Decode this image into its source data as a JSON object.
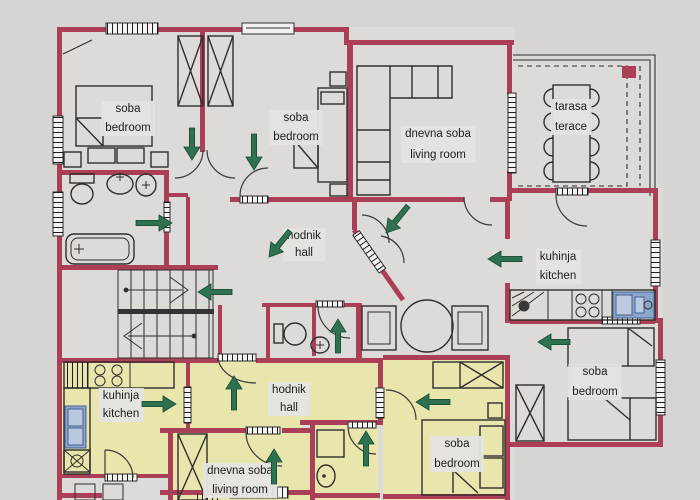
{
  "plan": {
    "type": "apartment floor plan",
    "colors": {
      "bg": "#d6d5d2",
      "room": "#dcdbd7",
      "room_highlight": "#e8e6ad",
      "wall": "#ac3f58",
      "ink": "#2f2e2c",
      "arrow_green": "#2f7252",
      "arrow_green_dark": "#174a30",
      "blue": "#8ba6cc",
      "label_bg": "#e5e4e0",
      "text": "#1c1c1b"
    },
    "labels": [
      {
        "id": "bedroom-top-left",
        "x": 128,
        "lines": [
          {
            "t": "soba",
            "y": 112
          },
          {
            "t": "bedroom",
            "y": 131
          }
        ]
      },
      {
        "id": "bedroom-top-center",
        "x": 296,
        "lines": [
          {
            "t": "soba",
            "y": 121
          },
          {
            "t": "bedroom",
            "y": 140
          }
        ]
      },
      {
        "id": "living-room-top",
        "x": 438,
        "lines": [
          {
            "t": "dnevna soba",
            "y": 137
          },
          {
            "t": "living room",
            "y": 158
          }
        ]
      },
      {
        "id": "terrace",
        "x": 571,
        "lines": [
          {
            "t": "tarasa",
            "y": 110
          },
          {
            "t": "terace",
            "y": 130
          }
        ]
      },
      {
        "id": "hall-upper",
        "x": 304,
        "lines": [
          {
            "t": "hodnik",
            "y": 239
          },
          {
            "t": "hall",
            "y": 256
          }
        ]
      },
      {
        "id": "kitchen-right",
        "x": 558,
        "lines": [
          {
            "t": "kuhinja",
            "y": 260
          },
          {
            "t": "kitchen",
            "y": 279
          }
        ]
      },
      {
        "id": "bedroom-right",
        "x": 595,
        "lines": [
          {
            "t": "soba",
            "y": 375
          },
          {
            "t": "bedroom",
            "y": 395
          }
        ]
      },
      {
        "id": "kitchen-lower",
        "x": 121,
        "lines": [
          {
            "t": "kuhinja",
            "y": 399
          },
          {
            "t": "kitchen",
            "y": 417
          }
        ]
      },
      {
        "id": "hall-lower",
        "x": 289,
        "lines": [
          {
            "t": "hodnik",
            "y": 393
          },
          {
            "t": "hall",
            "y": 411
          }
        ]
      },
      {
        "id": "living-room-lower",
        "x": 240,
        "lines": [
          {
            "t": "dnevna soba",
            "y": 474
          },
          {
            "t": "living room",
            "y": 493
          }
        ]
      },
      {
        "id": "bedroom-lower",
        "x": 457,
        "lines": [
          {
            "t": "soba",
            "y": 447
          },
          {
            "t": "bedroom",
            "y": 467
          }
        ]
      }
    ],
    "arrows": [
      {
        "name": "arrow-bedroom-top-left",
        "x1": 192,
        "y1": 128,
        "x2": 192,
        "y2": 160
      },
      {
        "name": "arrow-bedroom-top-center",
        "x1": 254,
        "y1": 134,
        "x2": 254,
        "y2": 170
      },
      {
        "name": "arrow-hall-upper-door",
        "x1": 408,
        "y1": 206,
        "x2": 386,
        "y2": 233
      },
      {
        "name": "arrow-hall-upper",
        "x1": 290,
        "y1": 231,
        "x2": 269,
        "y2": 257
      },
      {
        "name": "arrow-bathroom",
        "x1": 136,
        "y1": 223,
        "x2": 172,
        "y2": 223
      },
      {
        "name": "arrow-stairs",
        "x1": 232,
        "y1": 292,
        "x2": 198,
        "y2": 292
      },
      {
        "name": "arrow-wc-upper",
        "x1": 338,
        "y1": 353,
        "x2": 338,
        "y2": 319
      },
      {
        "name": "arrow-kitchen-right",
        "x1": 522,
        "y1": 259,
        "x2": 488,
        "y2": 259
      },
      {
        "name": "arrow-bedroom-right",
        "x1": 570,
        "y1": 342,
        "x2": 538,
        "y2": 342
      },
      {
        "name": "arrow-kitchen-lower",
        "x1": 142,
        "y1": 404,
        "x2": 176,
        "y2": 404
      },
      {
        "name": "arrow-hall-lower",
        "x1": 234,
        "y1": 410,
        "x2": 234,
        "y2": 376
      },
      {
        "name": "arrow-living-lower",
        "x1": 274,
        "y1": 484,
        "x2": 274,
        "y2": 449
      },
      {
        "name": "arrow-wc-lower",
        "x1": 366,
        "y1": 466,
        "x2": 366,
        "y2": 431
      },
      {
        "name": "arrow-bedroom-lower",
        "x1": 450,
        "y1": 402,
        "x2": 416,
        "y2": 402
      }
    ]
  }
}
